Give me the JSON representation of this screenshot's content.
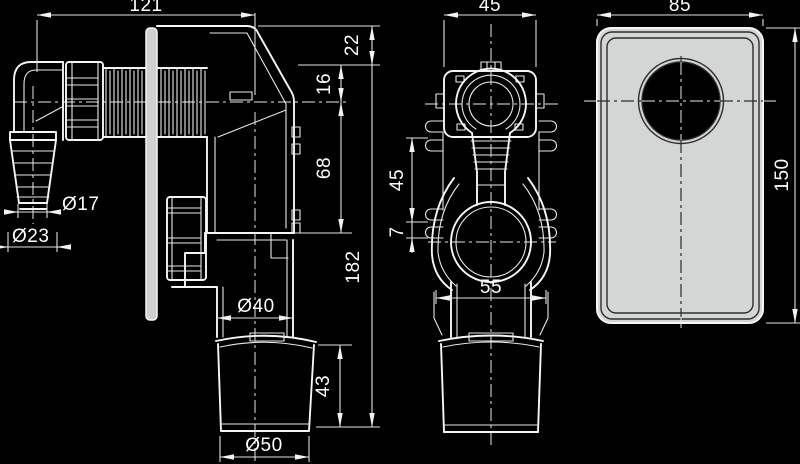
{
  "drawing": {
    "type": "technical-drawing",
    "subject": "wall-mounted washing machine siphon with cover plate, three orthographic views",
    "colors": {
      "background": "#000000",
      "line": "#ffffff",
      "plate_fill": "#d4d6d5",
      "hole_fill": "#000000"
    },
    "dims": {
      "side_total_width": "121",
      "side_depth_top": "22",
      "side_depth_upper": "16",
      "side_body_height": "68",
      "side_total_height": "182",
      "hose_inner_dia": "Ø17",
      "hose_outer_dia": "Ø23",
      "drain_pipe_dia": "Ø40",
      "cup_height": "43",
      "cup_dia": "Ø50",
      "front_flange_width": "45",
      "front_clip_span": "45",
      "front_clip_gap": "7",
      "front_body_width": "55",
      "plate_width": "85",
      "plate_height": "150"
    }
  }
}
